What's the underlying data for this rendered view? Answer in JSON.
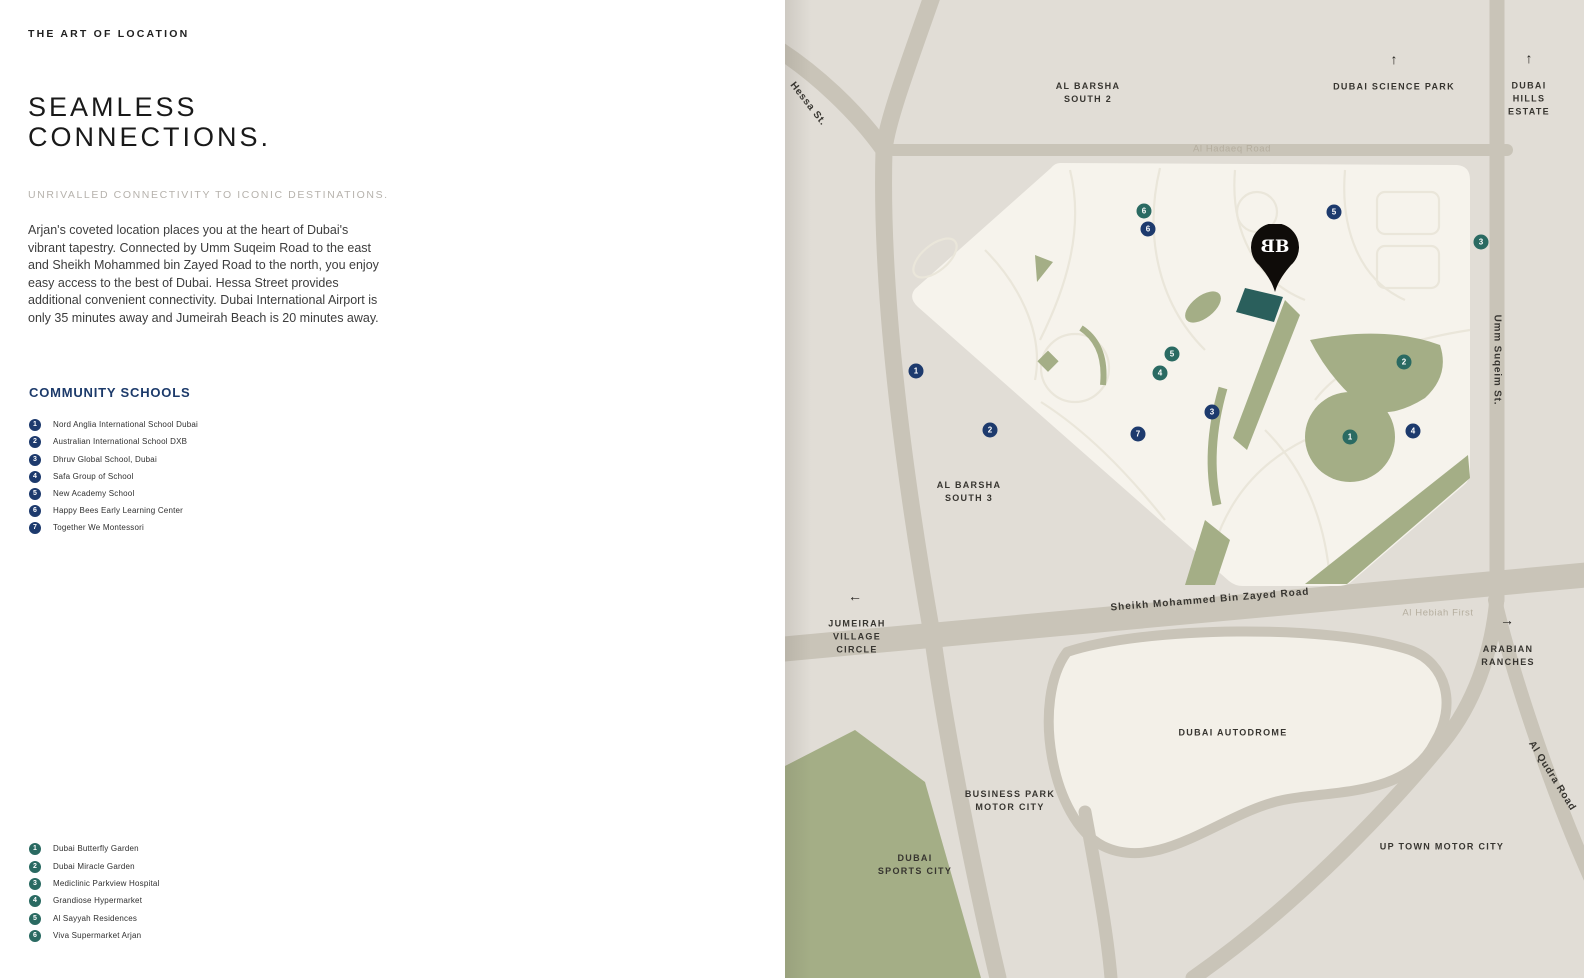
{
  "page": {
    "eyebrow": "THE ART OF LOCATION",
    "title": "SEAMLESS\nCONNECTIONS.",
    "subtitle": "UNRIVALLED CONNECTIVITY TO ICONIC DESTINATIONS.",
    "body": "Arjan's coveted location places you at the heart of Dubai's vibrant tapestry. Connected by Umm Suqeim Road to the east and Sheikh Mohammed bin Zayed Road to the north, you enjoy easy access to the best of Dubai. Hessa Street provides additional convenient connectivity. Dubai International Airport is only 35 minutes away and Jumeirah Beach is 20 minutes away."
  },
  "schools": {
    "heading": "COMMUNITY SCHOOLS",
    "marker_color": "#1d3a6d",
    "items": [
      {
        "num": "1",
        "label": "Nord Anglia International School Dubai"
      },
      {
        "num": "2",
        "label": "Australian International School DXB"
      },
      {
        "num": "3",
        "label": "Dhruv Global School, Dubai"
      },
      {
        "num": "4",
        "label": "Safa Group of School"
      },
      {
        "num": "5",
        "label": "New Academy School"
      },
      {
        "num": "6",
        "label": "Happy Bees Early Learning Center"
      },
      {
        "num": "7",
        "label": "Together We Montessori"
      }
    ]
  },
  "amenities": {
    "marker_color": "#2a6a62",
    "items": [
      {
        "num": "1",
        "label": "Dubai Butterfly Garden"
      },
      {
        "num": "2",
        "label": "Dubai Miracle Garden"
      },
      {
        "num": "3",
        "label": "Mediclinic Parkview Hospital"
      },
      {
        "num": "4",
        "label": "Grandiose Hypermarket"
      },
      {
        "num": "5",
        "label": "Al Sayyah Residences"
      },
      {
        "num": "6",
        "label": "Viva Supermarket Arjan"
      }
    ]
  },
  "map": {
    "colors": {
      "background": "#e1ddd6",
      "road": "#c9c4b8",
      "community": "#f6f3ec",
      "autodrome": "#f3f0e8",
      "green": "#a4ae86",
      "pin": "#0f0c09",
      "plot_teal": "#2a5f5c",
      "label_dark": "#373530",
      "label_light": "#b5ae9f"
    },
    "arrows": {
      "up": "↑",
      "left": "←",
      "right": "→"
    },
    "labels": {
      "hessa_st": "Hessa St.",
      "al_barsha_south_2": "AL BARSHA\nSOUTH 2",
      "dubai_science_park": "DUBAI SCIENCE PARK",
      "dubai_hills_estate": "DUBAI\nHILLS\nESTATE",
      "al_hadaeq_road": "Al Hadaeq Road",
      "umm_suqeim_st": "Umm Suqeim St.",
      "al_barsha_south_3": "AL BARSHA\nSOUTH 3",
      "jumeirah_village_circle": "JUMEIRAH\nVILLAGE\nCIRCLE",
      "sheikh_mohammed_bin_zayed_road": "Sheikh Mohammed Bin Zayed Road",
      "al_hebiah_first": "Al Hebiah First",
      "arabian_ranches": "ARABIAN\nRANCHES",
      "al_qudra_road": "Al Qudra Road",
      "dubai_autodrome": "DUBAI AUTODROME",
      "business_park_motor_city": "BUSINESS PARK\nMOTOR CITY",
      "dubai_sports_city": "DUBAI\nSPORTS CITY",
      "up_town_motor_city": "UP TOWN MOTOR CITY"
    },
    "pin_logo": {
      "left_glyph": "B",
      "right_glyph": "B"
    },
    "school_markers": [
      {
        "num": "1"
      },
      {
        "num": "2"
      },
      {
        "num": "3"
      },
      {
        "num": "4"
      },
      {
        "num": "5"
      },
      {
        "num": "6"
      },
      {
        "num": "7"
      }
    ],
    "amenity_markers": [
      {
        "num": "1"
      },
      {
        "num": "2"
      },
      {
        "num": "3"
      },
      {
        "num": "4"
      },
      {
        "num": "5"
      },
      {
        "num": "6"
      }
    ]
  }
}
